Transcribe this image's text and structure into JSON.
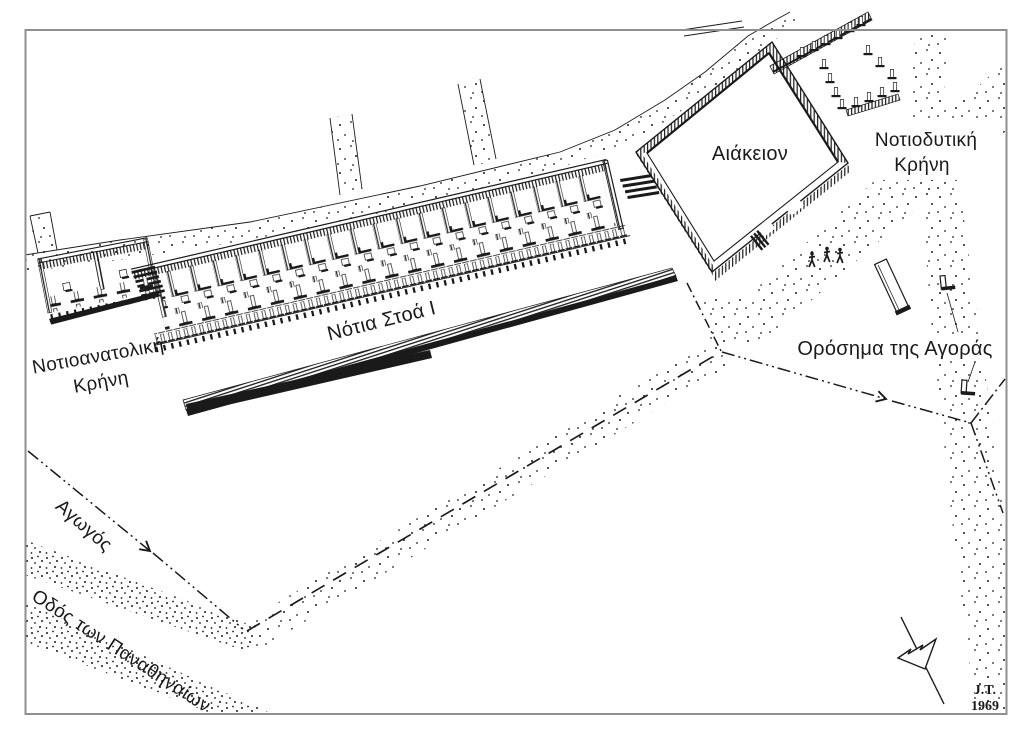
{
  "figure": {
    "type": "archaeological-reconstruction-drawing",
    "subject": "Athenian Agora, south side: South Stoa I, Aiakeion, fountain houses and Panathenaic Way",
    "labels": {
      "south_stoa": "Νότια Στοά Ι",
      "se_fountain": [
        "Νοτιοανατολική",
        "Κρήνη"
      ],
      "aiakeion": "Αιάκειον",
      "sw_fountain": [
        "Νοτιοδυτική",
        "Κρήνη"
      ],
      "agora_boundary_stones": "Ορόσημα της Αγοράς",
      "conduit": "Αγωγός",
      "panathenaic_way": "Οδός των Παναθηναίων"
    },
    "signature": {
      "initials": "J.T.",
      "year": "1969"
    },
    "colors": {
      "ink": "#1a1a1a",
      "paper": "#ffffff",
      "frame": "#8f8f8f"
    }
  }
}
